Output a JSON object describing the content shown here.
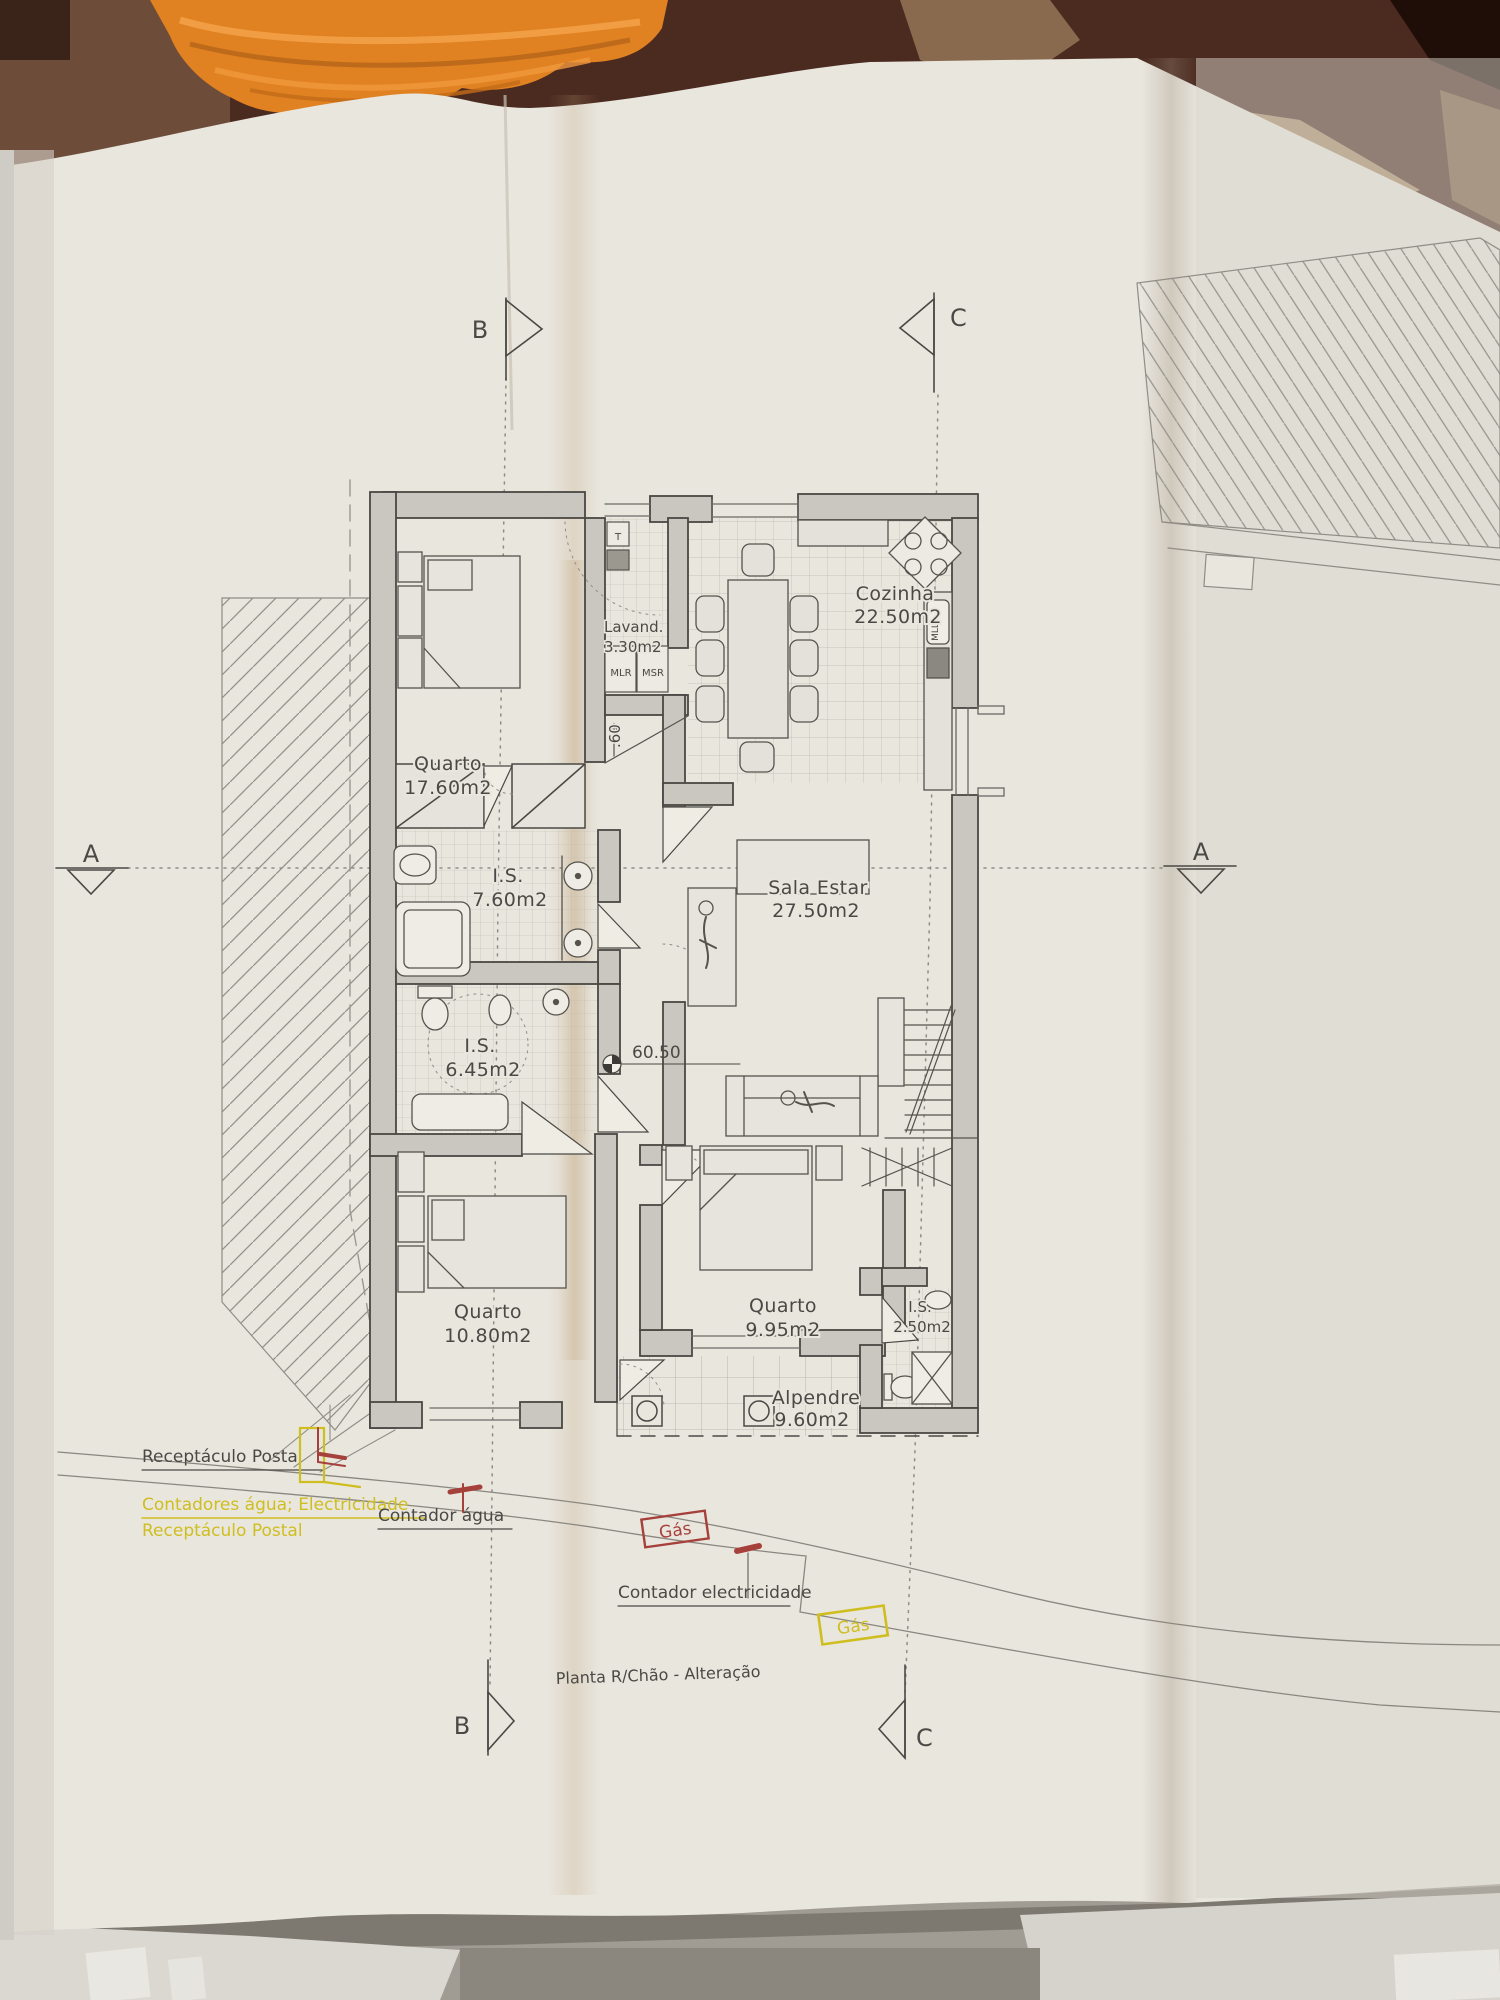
{
  "photo": {
    "description": "architectural floor plan sheet on table",
    "colors": {
      "paper": "#e9e6de",
      "ink": "#4b4945",
      "annotation_yellow": "#cfbe1f",
      "annotation_red": "#a6403a",
      "towel_orange": "#e08122",
      "table_brown": "#4b2a20"
    }
  },
  "plan": {
    "title": "Planta R/Chão - Alteração",
    "rooms": [
      {
        "name": "Quarto",
        "area": "17.60m2"
      },
      {
        "name": "Lavand.",
        "area": "3.30m2"
      },
      {
        "name": "Cozinha",
        "area": "22.50m2"
      },
      {
        "name": "I.S.",
        "area": "7.60m2"
      },
      {
        "name": "Sala Estar",
        "area": "27.50m2"
      },
      {
        "name": "I.S.",
        "area": "6.45m2"
      },
      {
        "name": "Quarto",
        "area": "10.80m2"
      },
      {
        "name": "Quarto",
        "area": "9.95m2"
      },
      {
        "name": "I.S.",
        "area": "2.50m2"
      },
      {
        "name": "Alpendre",
        "area": "9.60m2"
      }
    ],
    "appliances": {
      "t": "T",
      "mlr": "MLR",
      "msr": "MSR",
      "mll": "MLL"
    },
    "level_mark": "60.50",
    "step_mark": ".60",
    "markers": {
      "a": "A",
      "b": "B",
      "c": "C"
    },
    "annotations": {
      "postal_gray": "Receptáculo Postal",
      "contadores_yellow": "Contadores água; Electricidade",
      "postal_yellow": "Receptáculo Postal",
      "contador_agua": "Contador água",
      "gas_red": "Gás",
      "contador_elec": "Contador electricidade",
      "gas_yellow": "Gás"
    }
  }
}
